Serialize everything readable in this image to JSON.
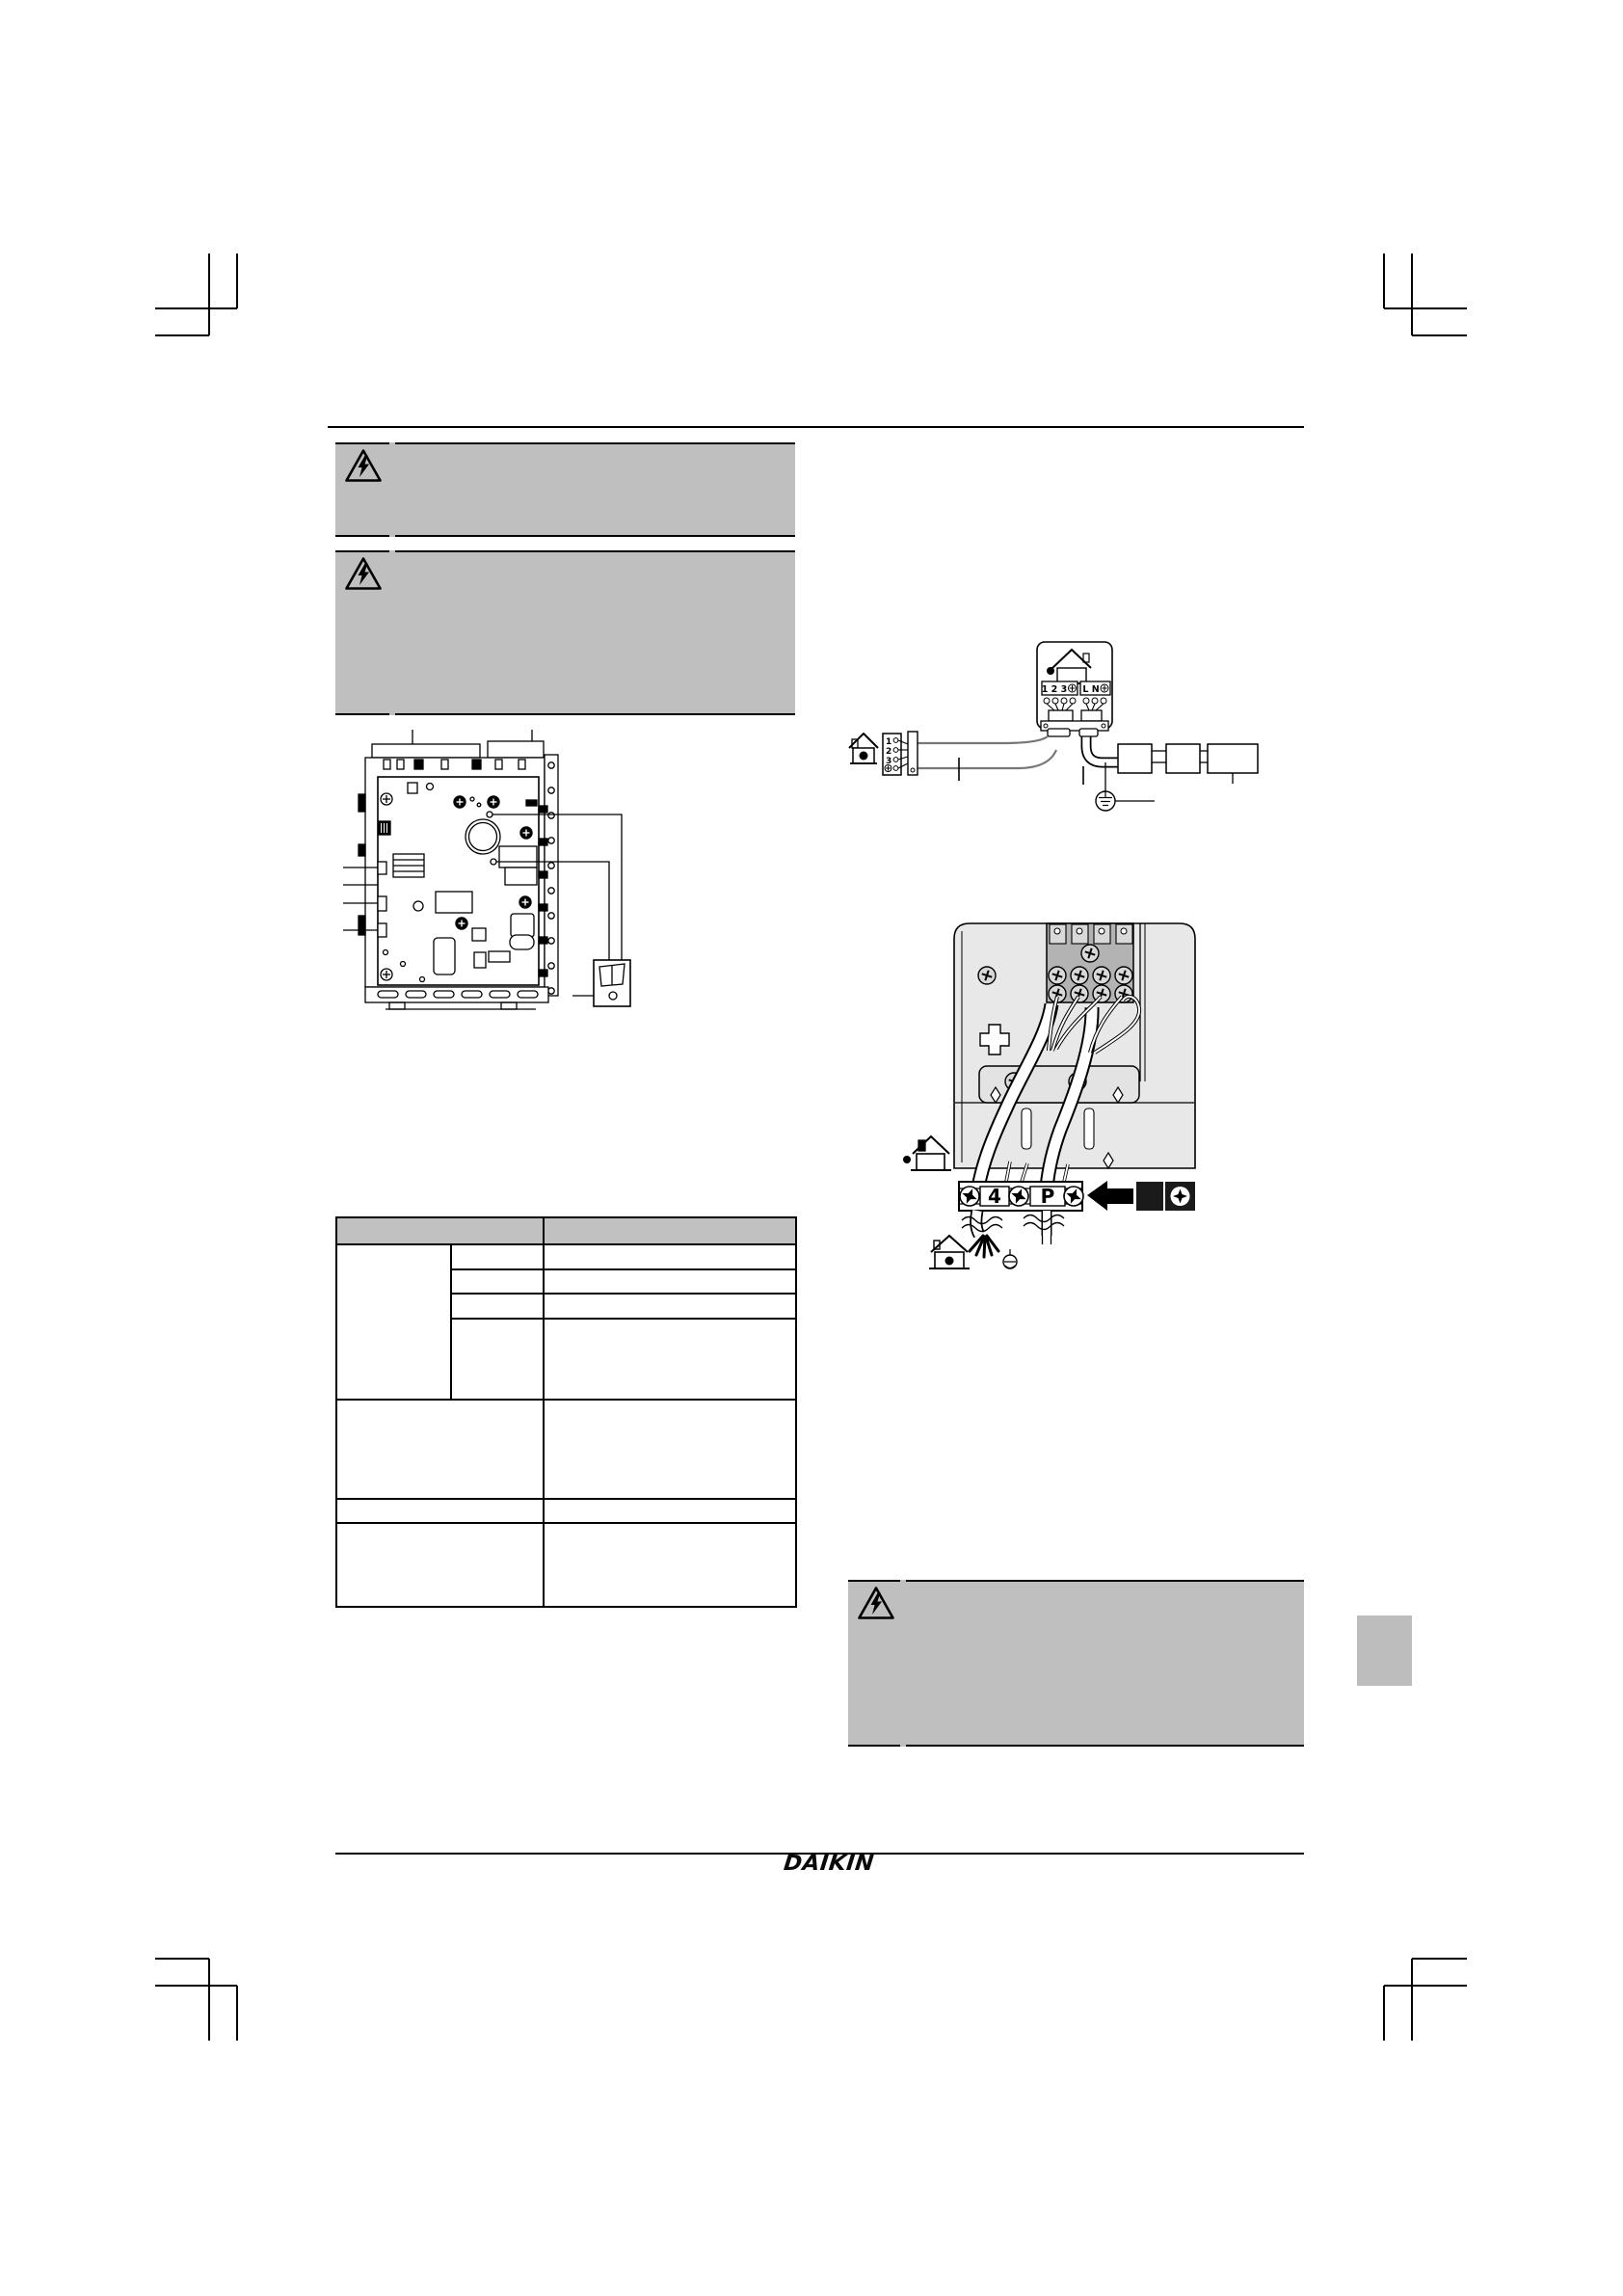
{
  "footer": {
    "brand": "DAIKIN"
  },
  "colors": {
    "warning_box_bg": "#bfbfbf",
    "table_header_bg": "#c1c1c1",
    "unit_panel_gray": "#e8e8e8",
    "terminal_block_gray": "#b3b3b3",
    "wire_gray": "#777777",
    "side_tab_gray": "#bdbdbd"
  },
  "icons": {
    "warning": "electrical-hazard-triangle",
    "unit_reference": "house-with-dot",
    "earth": "protective-earth-symbol",
    "screwdriver": "phillips-bit-in-circle",
    "direction": "left-arrow"
  },
  "wiring_overview": {
    "indoor_terminal_labels": "1 2 3",
    "power_terminal_labels": "L N",
    "remote_terminals": [
      "1",
      "2",
      "3"
    ]
  },
  "terminal_closeup": {
    "terminal_labels": [
      "4",
      "P"
    ]
  }
}
